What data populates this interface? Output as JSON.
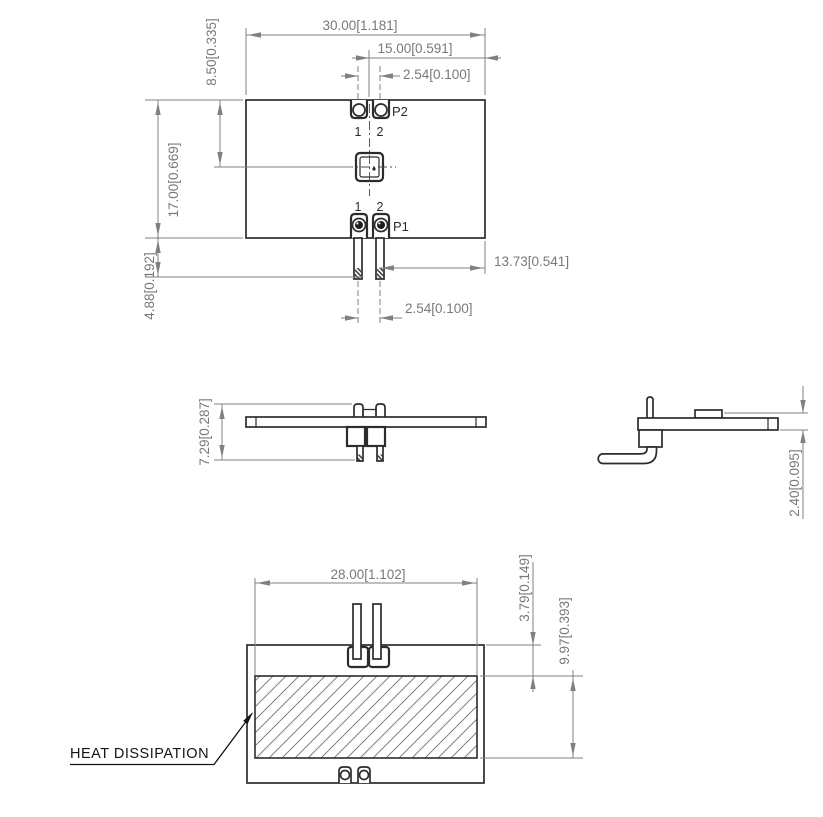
{
  "drawing": {
    "colors": {
      "object_line": "#2c2c2e",
      "dimension_line": "#7e8083",
      "dimension_text": "#77797c",
      "hatch": "#6f7173"
    },
    "views": {
      "top": {
        "dims": {
          "overall_width": "30.00[1.181]",
          "center_to_edge": "15.00[0.591]",
          "pin_pitch_top": "2.54[0.100]",
          "led_offset": "8.50[0.335]",
          "overall_depth": "17.00[0.669]",
          "pin_length": "4.88[0.192]",
          "pin_to_edge": "13.73[0.541]",
          "pin_pitch_bottom": "2.54[0.100]"
        },
        "labels": {
          "p2": "P2",
          "p1": "P1",
          "pin1": "1",
          "pin2": "2"
        }
      },
      "front": {
        "dims": {
          "overall_height": "7.29[0.287]"
        }
      },
      "side": {
        "dims": {
          "thickness": "2.40[0.095]"
        }
      },
      "bottom": {
        "dims": {
          "pad_width": "28.00[1.102]",
          "pad_offset": "3.79[0.149]",
          "pad_height": "9.97[0.393]"
        },
        "callout": "HEAT DISSIPATION"
      }
    }
  }
}
